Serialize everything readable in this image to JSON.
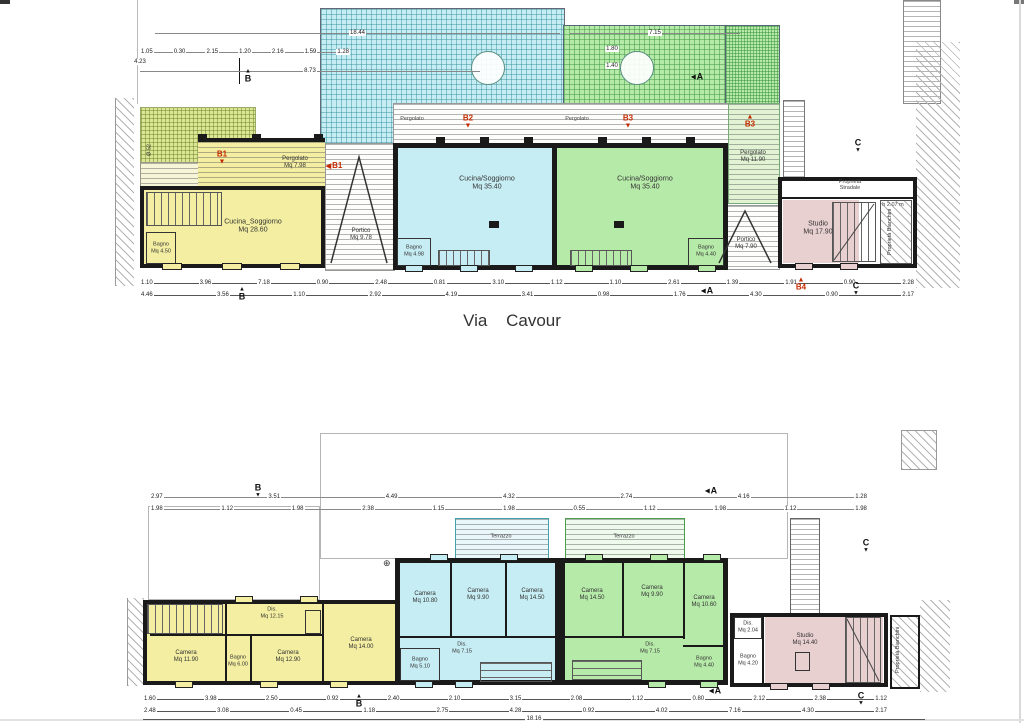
{
  "palette": {
    "yellow": "#f3eea1",
    "cyan": "#c6edf3",
    "green": "#b6eaa9",
    "pink": "#e8cfd0",
    "pergola_green": "#dbe794",
    "wall": "#1a1a1a",
    "marker_red": "#c62b00"
  },
  "street": {
    "label": "Via Cavour"
  },
  "g": {
    "totals": {
      "top": "18.44",
      "sub": "8.73",
      "left": "4.23",
      "right_seg": "7.15"
    },
    "dim_row_top": [
      "1.05",
      "0.30",
      "2.15",
      "1.20",
      "2.16",
      "1.59",
      "1.28"
    ],
    "circle_dims": [
      "1.80",
      "1.40"
    ],
    "diameter_note": "Ø 52",
    "markers": {
      "b1": "B1",
      "b2": "B2",
      "b3": "B3",
      "b4": "B4"
    },
    "sections": {
      "a": "A",
      "b": "B",
      "c": "C"
    },
    "pergola_b1": {
      "label": "Pergolato",
      "area": "Mq 7.98"
    },
    "pergola_b2": {
      "label": "Pergolato"
    },
    "pergola_b3_band": {
      "label": "Pergolato"
    },
    "pergola_b3": {
      "label": "Pergolato",
      "area": "Mq 11.90"
    },
    "portico_1": {
      "label": "Portico",
      "area": "Mq 9.78"
    },
    "portico_2": {
      "label": "Portico",
      "area": "Mq 7.90"
    },
    "rooms": {
      "b1_main": {
        "label": "Cucina_Soggiorno",
        "area": "Mq 28.60"
      },
      "b1_bagno": {
        "label": "Bagno",
        "area": "Mq 4.50"
      },
      "b2_main": {
        "label": "Cucina/Soggiorno",
        "area": "Mq 35.40"
      },
      "b2_bagno": {
        "label": "Bagno",
        "area": "Mq 4.98"
      },
      "b3_main": {
        "label": "Cucina/Soggiorno",
        "area": "Mq 35.40"
      },
      "b3_bagno": {
        "label": "Bagno",
        "area": "Mq 4.40"
      },
      "b4_studio": {
        "label": "Studio",
        "area": "Mq 17.90"
      }
    },
    "notes": {
      "prop_top_1": "Proprietà",
      "prop_top_2": "Stradale",
      "prop_side_1": "Proprietà",
      "prop_side_2": "Bianchini",
      "height": "h 2.07 m"
    },
    "dim_row_bottom1": [
      "1.10",
      "3.96",
      "7.18",
      "0.90",
      "2.48",
      "0.81",
      "3.10",
      "1.12",
      "1.10",
      "2.61",
      "1.39",
      "1.91",
      "0.90",
      "2.28"
    ],
    "dim_row_bottom2": [
      "4.46",
      "3.56",
      "1.10",
      "2.92",
      "4.19",
      "3.41",
      "0.98",
      "1.76",
      "4.30",
      "0.90",
      "2.17"
    ]
  },
  "f": {
    "sections": {
      "a": "A",
      "b": "B",
      "c": "C"
    },
    "terrazzo_b2": {
      "label": "Terrazzo"
    },
    "terrazzo_b3": {
      "label": "Terrazzo"
    },
    "symbols": {
      "survey": "⊕"
    },
    "rooms": {
      "b1_cam1": {
        "label": "Camera",
        "area": "Mq 11.90"
      },
      "b1_bagno": {
        "label": "Bagno",
        "area": "Mq 6.00"
      },
      "b1_dis": {
        "label": "Dis.",
        "area": "Mq 12.15"
      },
      "b1_cam2": {
        "label": "Camera",
        "area": "Mq 12.90"
      },
      "b1_cam3": {
        "label": "Camera",
        "area": "Mq 14.00"
      },
      "b2_cam1": {
        "label": "Camera",
        "area": "Mq 10.80"
      },
      "b2_cam2": {
        "label": "Camera",
        "area": "Mq 9.90"
      },
      "b2_cam3": {
        "label": "Camera",
        "area": "Mq 14.50"
      },
      "b2_dis": {
        "label": "Dis.",
        "area": "Mq 7.15"
      },
      "b2_bagno": {
        "label": "Bagno",
        "area": "Mq 5.10"
      },
      "b3_cam1": {
        "label": "Camera",
        "area": "Mq 14.50"
      },
      "b3_cam2": {
        "label": "Camera",
        "area": "Mq 9.90"
      },
      "b3_cam3": {
        "label": "Camera",
        "area": "Mq 10.60"
      },
      "b3_dis": {
        "label": "Dis.",
        "area": "Mq 7.15"
      },
      "b3_bagno": {
        "label": "Bagno",
        "area": "Mq 4.40"
      },
      "b4_dis": {
        "label": "Dis.",
        "area": "Mq 2.04"
      },
      "b4_bagno": {
        "label": "Bagno",
        "area": "Mq 4.20"
      },
      "b4_studio": {
        "label": "Studio",
        "area": "Mq 14.40"
      }
    },
    "notes": {
      "prop_side_1": "Proprietà",
      "prop_side_2": "Bianchini"
    },
    "dim_row_top1": [
      "2.97",
      "3.51",
      "4.49",
      "4.32",
      "2.74",
      "4.16",
      "1.28"
    ],
    "dim_row_top2": [
      "1.98",
      "1.12",
      "1.98",
      "2.38",
      "1.15",
      "1.98",
      "0.55",
      "1.12",
      "1.98",
      "1.12",
      "1.98"
    ],
    "dim_row_bottom1": [
      "1.60",
      "3.98",
      "2.50",
      "0.92",
      "2.40",
      "2.10",
      "3.15",
      "2.08",
      "1.12",
      "0.80",
      "2.12",
      "2.38",
      "1.12"
    ],
    "dim_row_bottom2": [
      "2.48",
      "3.08",
      "0.45",
      "1.18",
      "2.75",
      "4.28",
      "0.92",
      "4.02",
      "7.16",
      "4.30",
      "2.17"
    ],
    "total": "18.16"
  }
}
